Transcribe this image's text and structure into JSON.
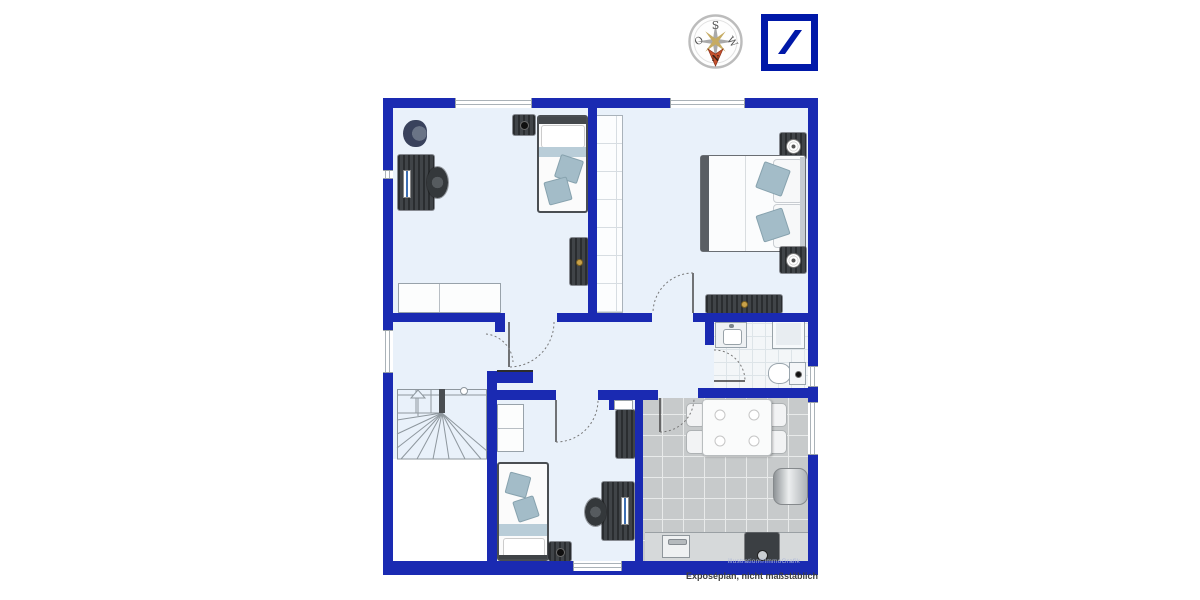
{
  "captions": {
    "credit": "illustration©ImmoGrafik",
    "disclaimer": "Exposéplan, nicht maßstäblich"
  },
  "compass": {
    "north": "N",
    "south": "S",
    "east": "O",
    "west": "W"
  },
  "icons": {
    "logo": "deutsche-bank-slash-logo",
    "compass": "compass-rose"
  },
  "colors": {
    "wall_blue": "#1a2ab2",
    "room_floor": "#e9f1fa",
    "kitchen_floor": "#c7cacb",
    "bathroom_floor": "#f3f6f8",
    "logo_blue": "#0018A8",
    "compass_needle": "#c4512d",
    "pillow_blue": "#a3bcc8",
    "furniture_dark": "#3a3e42"
  }
}
